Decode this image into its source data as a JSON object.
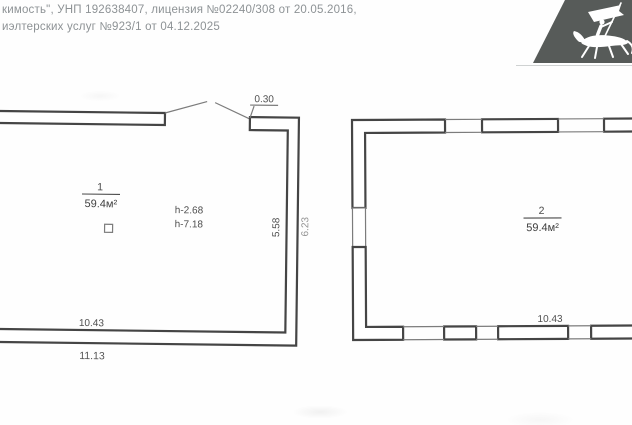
{
  "header": {
    "line1": "кимость\", УНП 192638407, лицензия №02240/308 от 20.05.2016,",
    "line2": "иэлтерских услуг №923/1 от 04.12.2025"
  },
  "logo": {
    "emblem": "knight-on-horseback-with-banner",
    "background_color": "#575b59"
  },
  "left_plan": {
    "room_number": "1",
    "area_label": "59.4м²",
    "ceiling_height": "h-2.68",
    "ridge_height": "h-7.18",
    "wall_offset_dim": "0.30",
    "inner_height_dim": "5.58",
    "outer_height_dim": "6.23",
    "inner_width_dim": "10.43",
    "outer_width_dim": "11.13"
  },
  "right_plan": {
    "room_number": "2",
    "area_label": "59.4м²",
    "inner_width_dim": "10.43"
  }
}
